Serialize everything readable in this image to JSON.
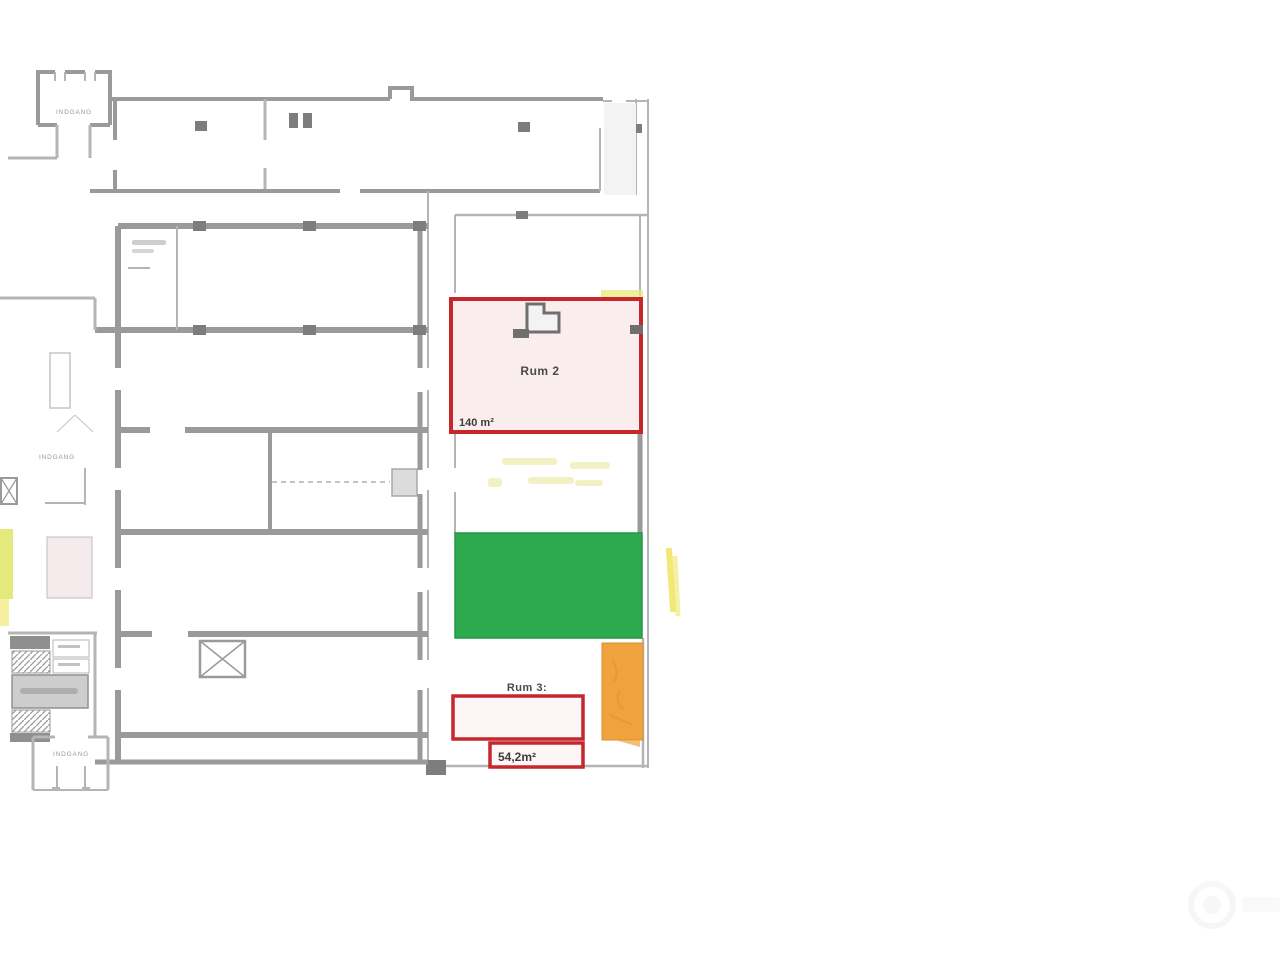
{
  "plan": {
    "rooms": {
      "rum2": {
        "label": "Rum 2",
        "area": "140 m²"
      },
      "rum3": {
        "label": "Rum 3:",
        "area": "54,2m²"
      }
    },
    "entrances": {
      "top": "INDGANG",
      "middle": "INDGANG",
      "bottom": "INDGANG"
    }
  },
  "colors": {
    "highlight_red": "#c5272d",
    "rum2_fill": "#f9edee",
    "rum3_fill": "#fdf6f6",
    "green": "#2daa4d",
    "green_edge": "#239843",
    "orange": "#f0a23e",
    "orange_edge": "#da8f2e",
    "yellow_streak": "#e8e87a",
    "yellow_marker": "#eee45f",
    "pink_room": "#f6ebec",
    "left_highlight": "#dde35e"
  }
}
